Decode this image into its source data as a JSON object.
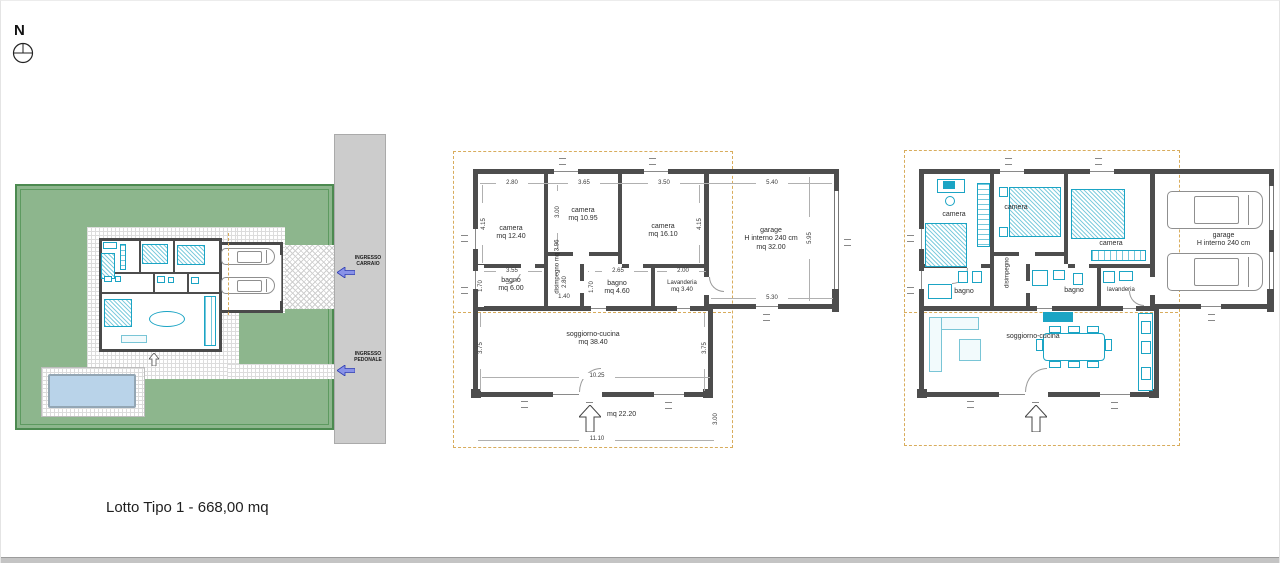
{
  "caption": "Lotto Tipo 1 -  668,00 mq",
  "compass": {
    "north_label": "N"
  },
  "colors": {
    "wall": "#4d4d4d",
    "furniture_cyan": "#1ba4c4",
    "lot_green": "#8db68d",
    "road_gray": "#cccccc",
    "pool_blue": "#b9d3e9",
    "boundary_dash_orange": "#d8ac5c",
    "entrance_arrow_blue": "#8892e8"
  },
  "site_plan": {
    "entrances": {
      "carraio": "INGRESSO\nCARRAIO",
      "pedonale": "INGRESSO\nPEDONALE"
    }
  },
  "plan_mid": {
    "rooms": {
      "camera1": "camera\nmq 12.40",
      "camera2": "camera\nmq 10.95",
      "camera3": "camera\nmq 16.10",
      "garage": "garage\nH interno 240 cm\nmq 32.00",
      "bagno1": "bagno\nmq 6.00",
      "disimpegno": "disimpegno mq 3.96",
      "bagno2": "bagno\nmq 4.60",
      "lavanderia": "Lavanderia\nmq 3.40",
      "soggiorno": "soggiorno-cucina\nmq 38.40",
      "portico": "mq 22.20"
    },
    "dims": {
      "top": [
        "2.80",
        "3.65",
        "3.50",
        "5.40"
      ],
      "cam1_h": "4.15",
      "cam2_h": "3.00",
      "cam3_h": "4.15",
      "garage_h": "5.95",
      "bagno1_w": "3.55",
      "bagno1_h": "1.70",
      "disimpegno_h": "2.80",
      "hall_w": "1.40",
      "bagno2_w": "2.65",
      "bagno2_h": "1.70",
      "lavanderia_w": "2.00",
      "garage_w2": "5.30",
      "sogg_h_left": "3.75",
      "sogg_h_right": "3.75",
      "sogg_w": "10.25",
      "total_w": "11.10",
      "porch_h": "3.00"
    }
  },
  "plan_right": {
    "rooms": {
      "camera1": "camera",
      "camera2": "camera",
      "camera3": "camera",
      "garage": "garage\nH interno 240 cm",
      "bagno1": "bagno",
      "disimpegno": "disimpegno",
      "bagno2": "bagno",
      "lavanderia": "lavanderia",
      "soggiorno": "soggiorno-cucina"
    }
  }
}
